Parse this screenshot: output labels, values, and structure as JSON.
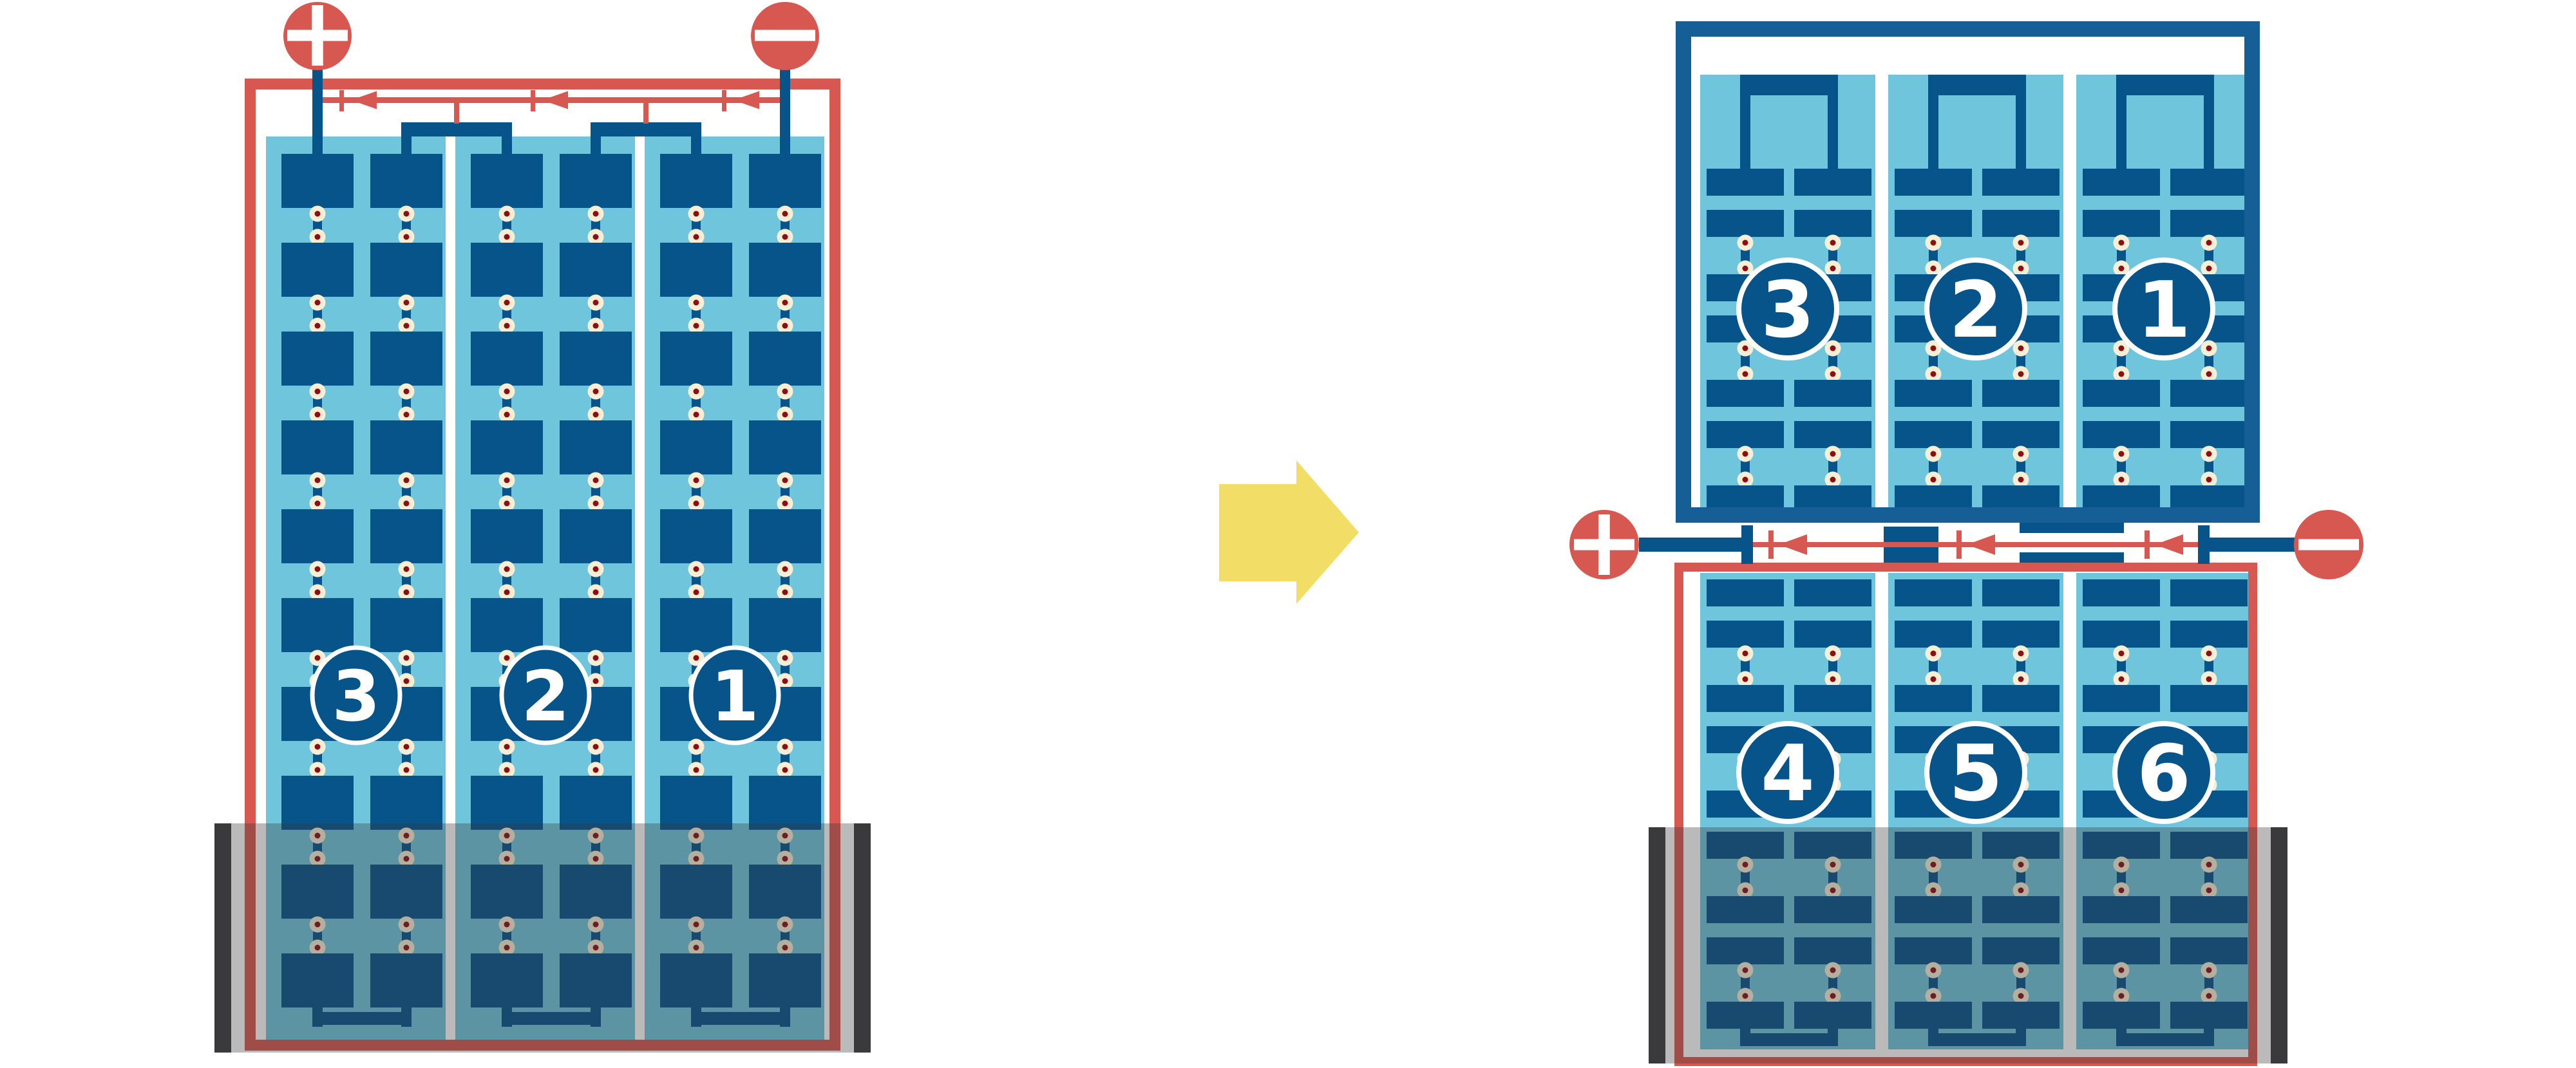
{
  "diagram_type": "battery-cell-series-connection",
  "colors": {
    "red": "#D75850",
    "dark_blue": "#07548A",
    "case_blue": "#155E96",
    "light_blue": "#6FC5DC",
    "cream": "#F7EED6",
    "rivet_red": "#8B1014",
    "yellow": "#F2DE67",
    "holder_gray": "#3A3A3C",
    "white": "#FFFFFF"
  },
  "left_battery": {
    "terminal_plus": "+",
    "terminal_minus": "−",
    "cells": [
      {
        "label": "3"
      },
      {
        "label": "2"
      },
      {
        "label": "1"
      }
    ]
  },
  "right_battery": {
    "terminal_plus": "+",
    "terminal_minus": "−",
    "top_unit": {
      "cells": [
        {
          "label": "3"
        },
        {
          "label": "2"
        },
        {
          "label": "1"
        }
      ]
    },
    "bottom_unit": {
      "cells": [
        {
          "label": "4"
        },
        {
          "label": "5"
        },
        {
          "label": "6"
        }
      ]
    }
  },
  "icons": {
    "transform": "arrow-right-icon",
    "current_direction": "arrowhead-left-icon",
    "positive_terminal": "plus-icon",
    "negative_terminal": "minus-icon"
  }
}
